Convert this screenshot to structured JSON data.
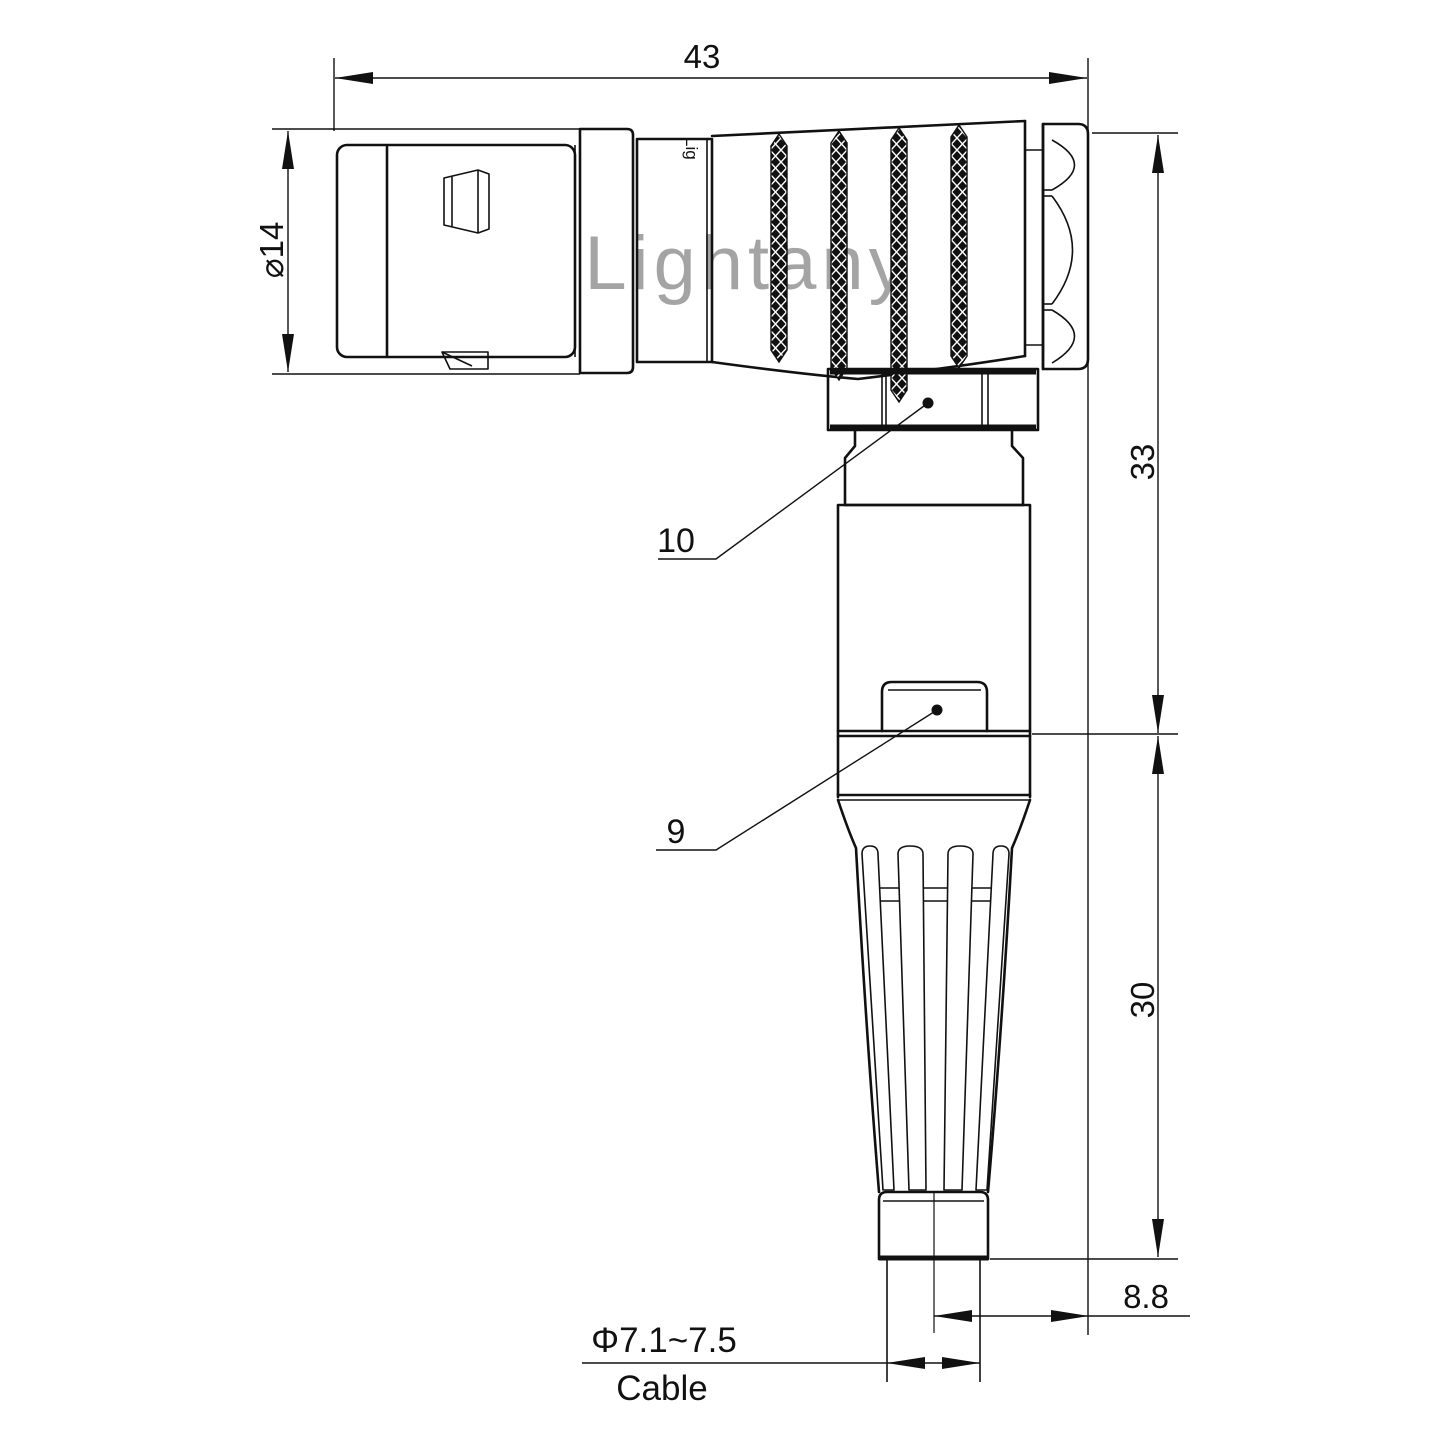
{
  "watermark": {
    "text": "Lightany"
  },
  "connector": {
    "body_marking": "Lig"
  },
  "dimensions": {
    "overall_length": "43",
    "shell_diameter": "⌀14",
    "upper_height": "33",
    "lower_height": "30",
    "cable_offset": "8.8",
    "cable_diameter": "Φ7.1~7.5",
    "cable_label": "Cable"
  },
  "callouts": {
    "coupling_nut": "10",
    "release_latch": "9"
  },
  "colors": {
    "line": "#111111",
    "watermark": "#db8888",
    "background": "#ffffff"
  }
}
